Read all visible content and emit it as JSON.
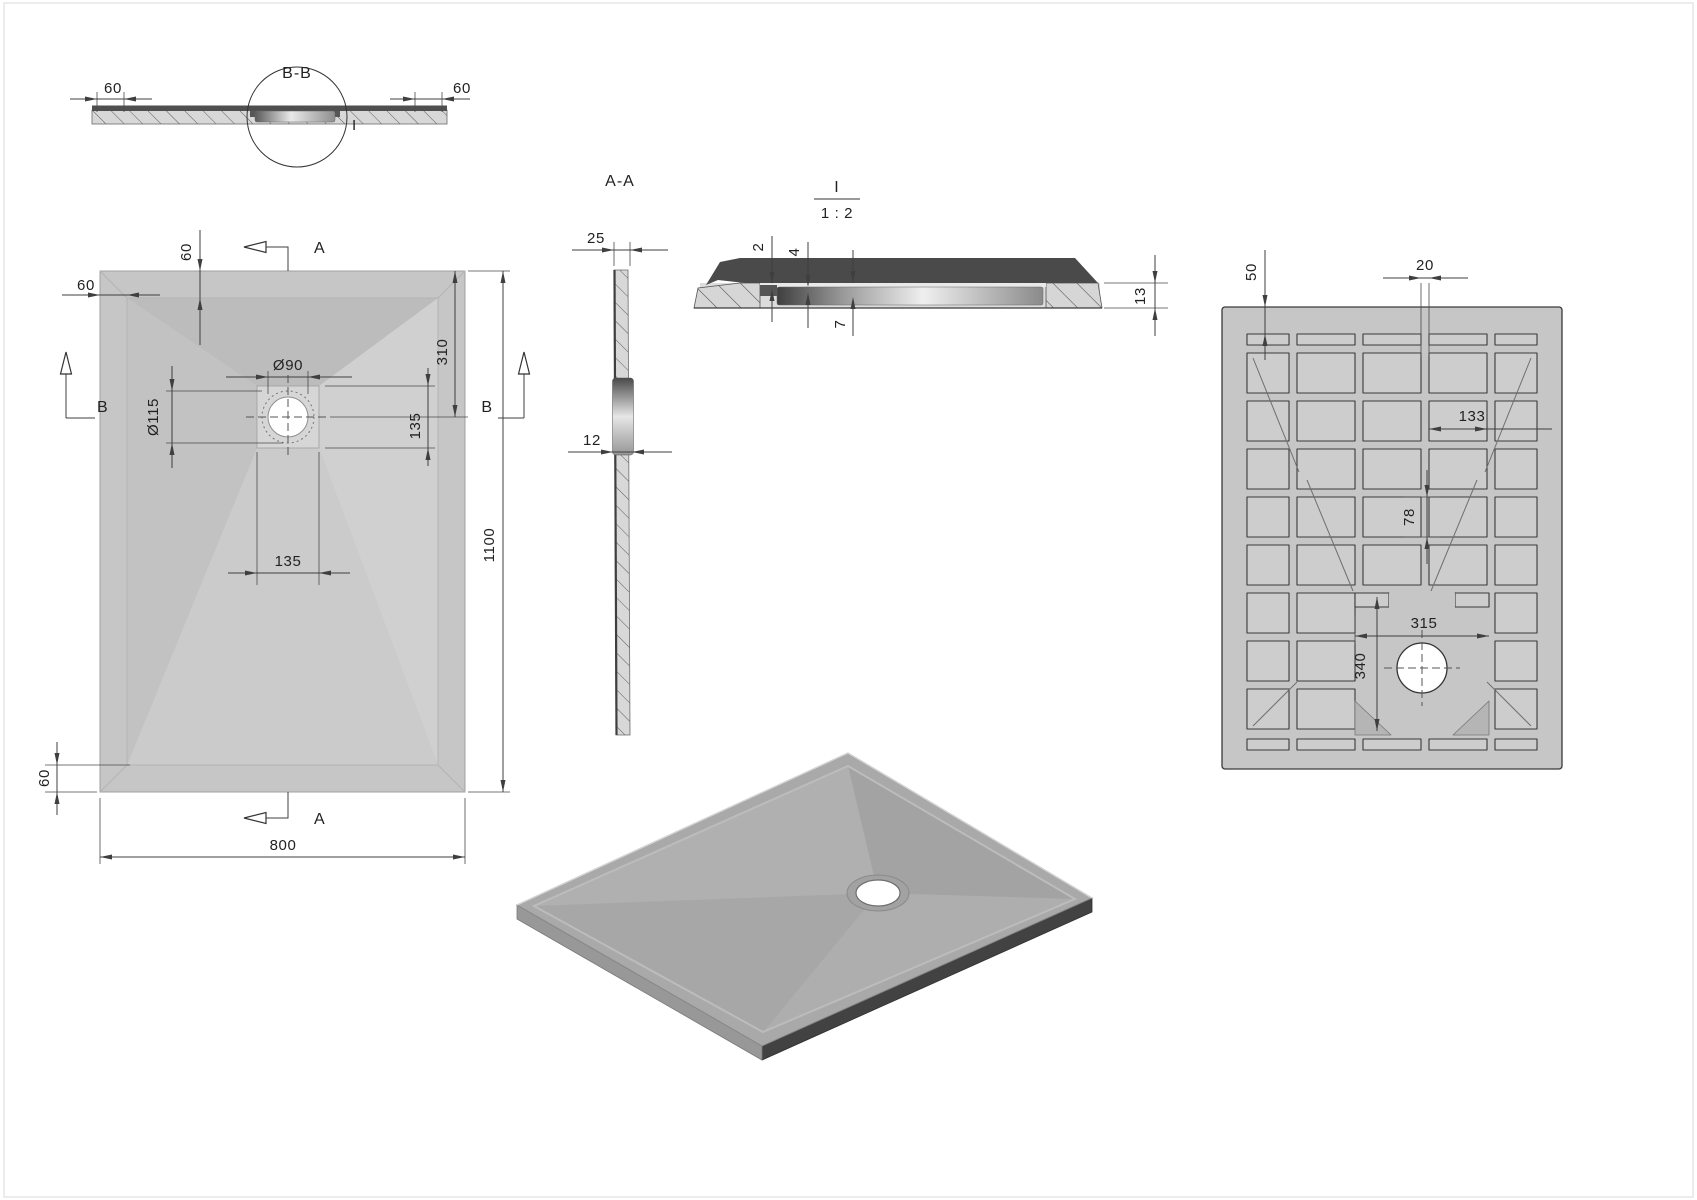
{
  "drawing": {
    "type": "technical-drawing",
    "subject": "rectangular shower tray with drain, orthographic views and detail",
    "background": "#ffffff",
    "line_color": "#3f3f3f",
    "body_gray": "#c6c6c6",
    "dark_surface": "#4a4a4a"
  },
  "labels": {
    "section_bb": {
      "title": "B-B",
      "detail_callout": "I",
      "dim_left": "60",
      "dim_right": "60"
    },
    "plan": {
      "section_a": "A",
      "section_b": "B",
      "dim_top_band": "60",
      "dim_left_band": "60",
      "dim_bottom_band": "60",
      "dim_drain_hole": "Ø90",
      "dim_drain_flange": "Ø115",
      "dim_drain_from_top": "310",
      "dim_recess_height": "135",
      "dim_recess_width": "135",
      "dim_width": "800",
      "dim_length": "1100"
    },
    "section_aa": {
      "title": "A-A",
      "dim_edge_thickness": "25",
      "dim_mid_thickness": "12"
    },
    "detail_i": {
      "title": "I",
      "scale": "1 : 2",
      "dim_lip": "2",
      "dim_step": "4",
      "dim_recess_depth": "7",
      "dim_total_thickness": "13"
    },
    "bottom_view": {
      "dim_edge_offset": "50",
      "dim_rib_width": "20",
      "dim_pocket_width": "133",
      "dim_pocket_height": "78",
      "dim_center_width": "315",
      "dim_center_height": "340"
    }
  }
}
